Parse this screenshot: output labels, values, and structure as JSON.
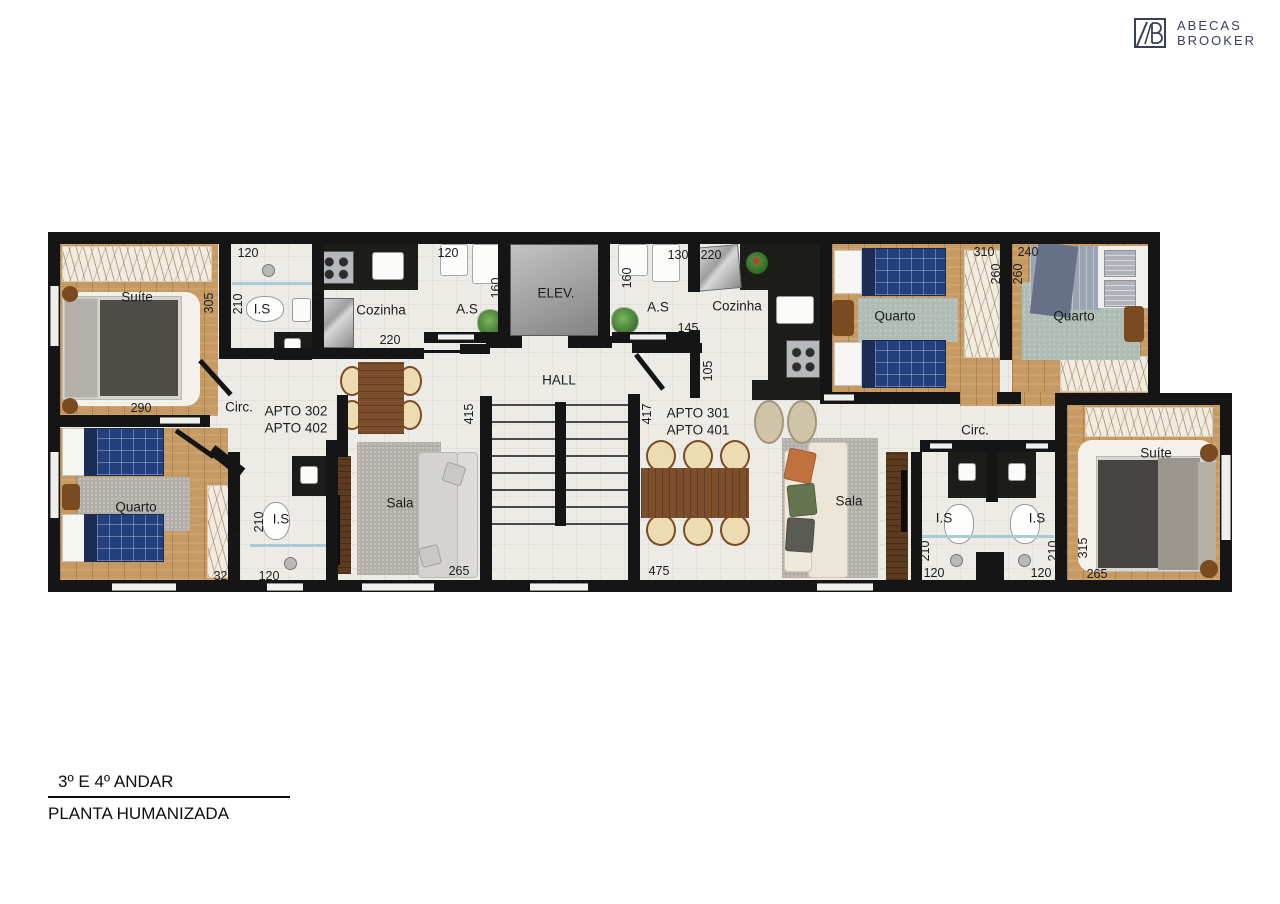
{
  "logo": {
    "monogram": "AB",
    "name_line1": "ABECAS",
    "name_line2": "BROOKER"
  },
  "title_block": {
    "line1": "3º E 4º ANDAR",
    "line2": "PLANTA HUMANIZADA"
  },
  "colors": {
    "wall": "#151515",
    "wood_floor": "#c69a62",
    "tile_floor": "#edebe5",
    "bed_navy": "#24407c",
    "logo_navy": "#39405e"
  },
  "plan": {
    "room_labels": [
      {
        "t": "Suíte",
        "x": 137,
        "y": 297
      },
      {
        "t": "I.S",
        "x": 262,
        "y": 309
      },
      {
        "t": "Cozinha",
        "x": 381,
        "y": 310
      },
      {
        "t": "A.S",
        "x": 467,
        "y": 309
      },
      {
        "t": "ELEV.",
        "x": 556,
        "y": 293
      },
      {
        "t": "A.S",
        "x": 658,
        "y": 307
      },
      {
        "t": "Cozinha",
        "x": 737,
        "y": 306
      },
      {
        "t": "Quarto",
        "x": 895,
        "y": 316
      },
      {
        "t": "Quarto",
        "x": 1074,
        "y": 316
      },
      {
        "t": "HALL",
        "x": 559,
        "y": 380
      },
      {
        "t": "Circ.",
        "x": 239,
        "y": 407
      },
      {
        "t": "Circ.",
        "x": 975,
        "y": 430
      },
      {
        "t": "Quarto",
        "x": 136,
        "y": 507
      },
      {
        "t": "I.S",
        "x": 281,
        "y": 519
      },
      {
        "t": "Sala",
        "x": 400,
        "y": 503
      },
      {
        "t": "Sala",
        "x": 849,
        "y": 501
      },
      {
        "t": "I.S",
        "x": 944,
        "y": 518
      },
      {
        "t": "I.S",
        "x": 1037,
        "y": 518
      },
      {
        "t": "Suíte",
        "x": 1156,
        "y": 453
      }
    ],
    "apartment_labels": [
      {
        "t": "APTO 302",
        "x": 296,
        "y": 411
      },
      {
        "t": "APTO 402",
        "x": 296,
        "y": 428
      },
      {
        "t": "APTO 301",
        "x": 698,
        "y": 413
      },
      {
        "t": "APTO 401",
        "x": 698,
        "y": 430
      }
    ],
    "dimension_labels": [
      {
        "t": "120",
        "x": 248,
        "y": 253
      },
      {
        "t": "305",
        "x": 209,
        "y": 303,
        "r": 1
      },
      {
        "t": "210",
        "x": 238,
        "y": 304,
        "r": 1
      },
      {
        "t": "180",
        "x": 319,
        "y": 290,
        "r": 1
      },
      {
        "t": "220",
        "x": 390,
        "y": 340
      },
      {
        "t": "120",
        "x": 448,
        "y": 253
      },
      {
        "t": "160",
        "x": 496,
        "y": 288,
        "r": 1
      },
      {
        "t": "290",
        "x": 141,
        "y": 408
      },
      {
        "t": "415",
        "x": 469,
        "y": 414,
        "r": 1
      },
      {
        "t": "417",
        "x": 647,
        "y": 414,
        "r": 1
      },
      {
        "t": "130",
        "x": 678,
        "y": 255
      },
      {
        "t": "220",
        "x": 711,
        "y": 255
      },
      {
        "t": "160",
        "x": 627,
        "y": 278,
        "r": 1
      },
      {
        "t": "145",
        "x": 688,
        "y": 328
      },
      {
        "t": "105",
        "x": 708,
        "y": 371,
        "r": 1
      },
      {
        "t": "310",
        "x": 984,
        "y": 252
      },
      {
        "t": "260",
        "x": 996,
        "y": 274,
        "r": 1
      },
      {
        "t": "240",
        "x": 1028,
        "y": 252
      },
      {
        "t": "260",
        "x": 1018,
        "y": 274,
        "r": 1
      },
      {
        "t": "275",
        "x": 234,
        "y": 544,
        "r": 1
      },
      {
        "t": "325",
        "x": 224,
        "y": 576
      },
      {
        "t": "120",
        "x": 269,
        "y": 576
      },
      {
        "t": "210",
        "x": 259,
        "y": 522,
        "r": 1
      },
      {
        "t": "265",
        "x": 459,
        "y": 571
      },
      {
        "t": "475",
        "x": 659,
        "y": 571
      },
      {
        "t": "210",
        "x": 925,
        "y": 551,
        "r": 1
      },
      {
        "t": "120",
        "x": 934,
        "y": 573
      },
      {
        "t": "210",
        "x": 1053,
        "y": 551,
        "r": 1
      },
      {
        "t": "120",
        "x": 1041,
        "y": 573
      },
      {
        "t": "315",
        "x": 1083,
        "y": 548,
        "r": 1
      },
      {
        "t": "265",
        "x": 1097,
        "y": 574
      }
    ]
  }
}
